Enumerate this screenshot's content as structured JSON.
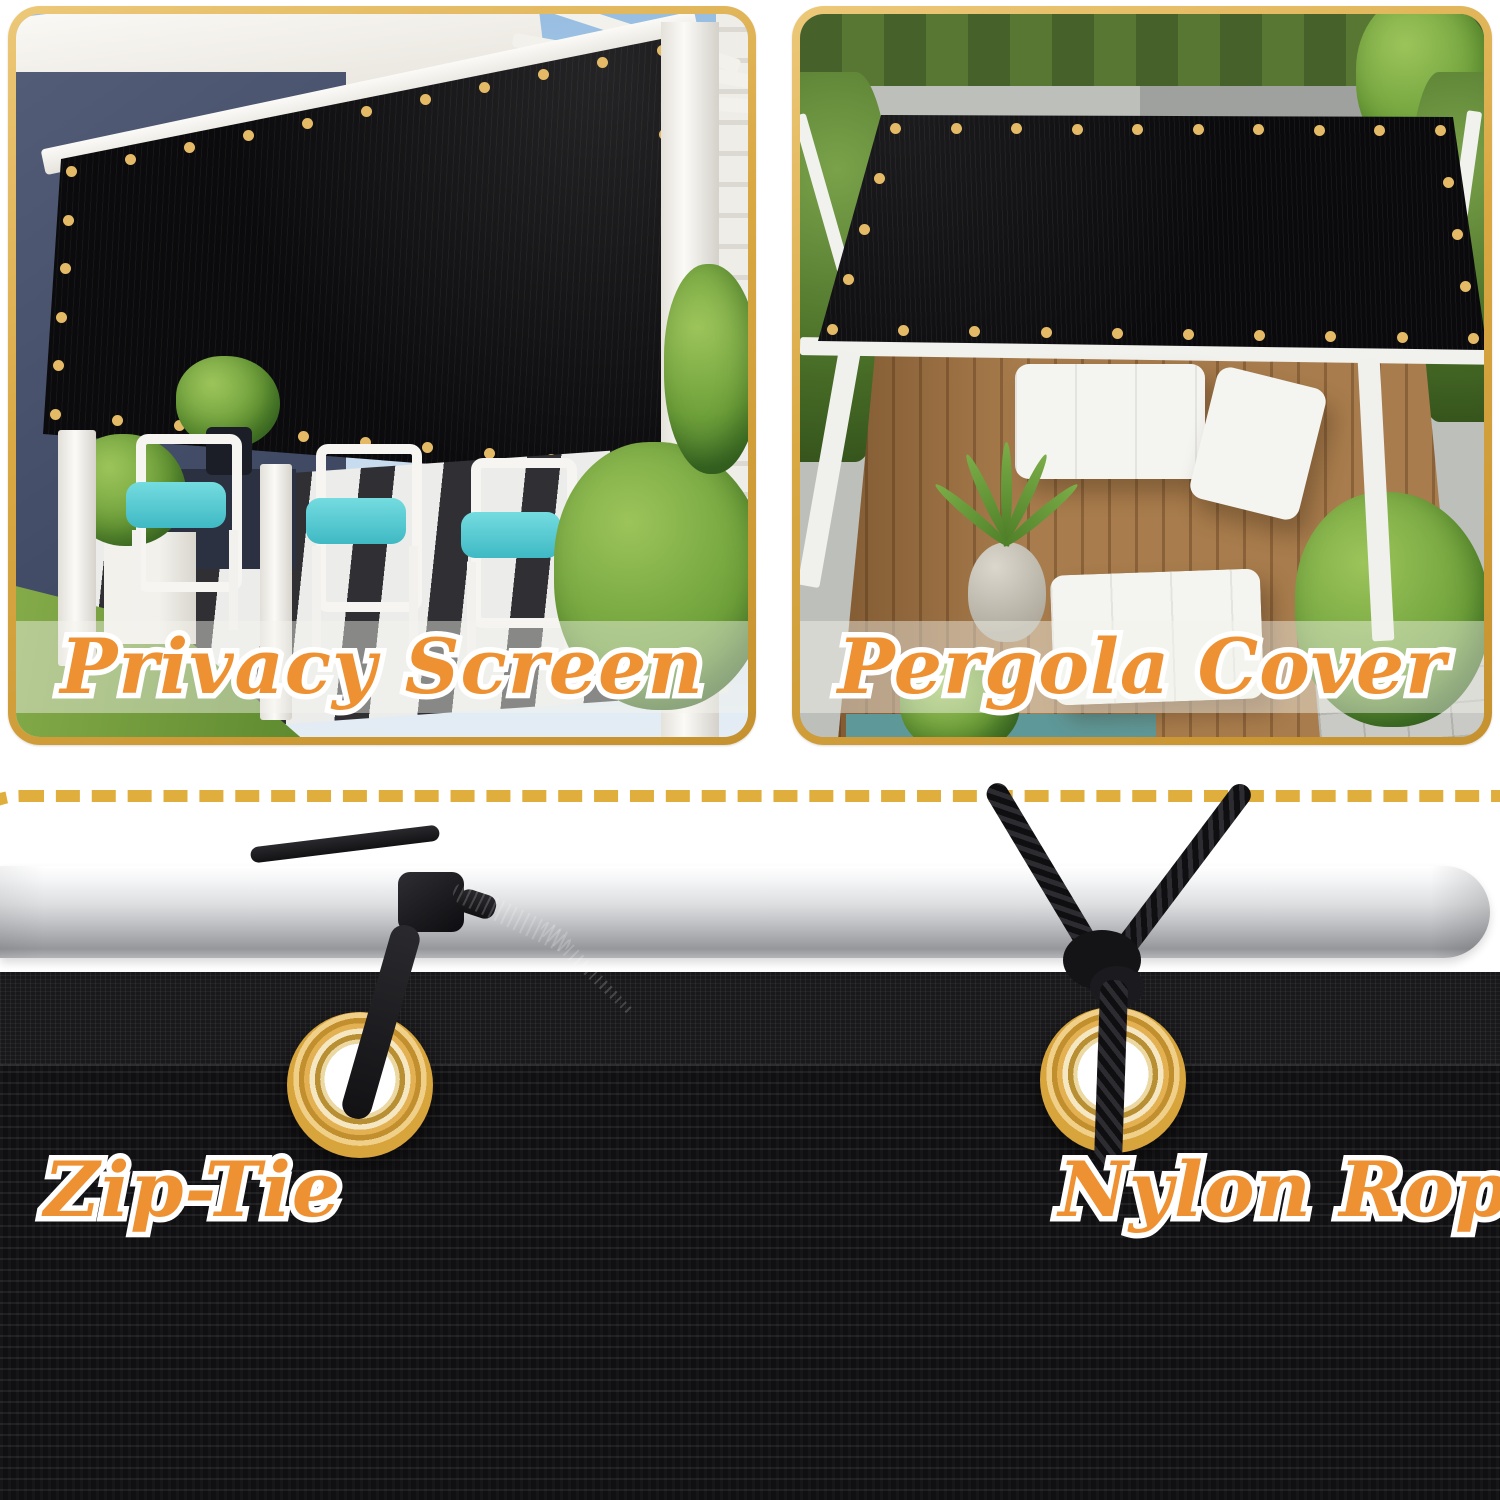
{
  "sections": {
    "privacy_screen": {
      "label": "Privacy Screen"
    },
    "pergola_cover": {
      "label": "Pergola Cover"
    },
    "zip_tie": {
      "label": "Zip-Tie"
    },
    "nylon_rope": {
      "label": "Nylon Rope"
    }
  },
  "colors": {
    "label_orange": "#EE9132",
    "label_outline": "#FFFFFF",
    "frame_gold": "#D9A843",
    "dash_gold": "#DFAE3C",
    "grommet_brass": "#DCA943",
    "mesh_black": "#121214",
    "pole_silver": "#C9CBCE"
  }
}
